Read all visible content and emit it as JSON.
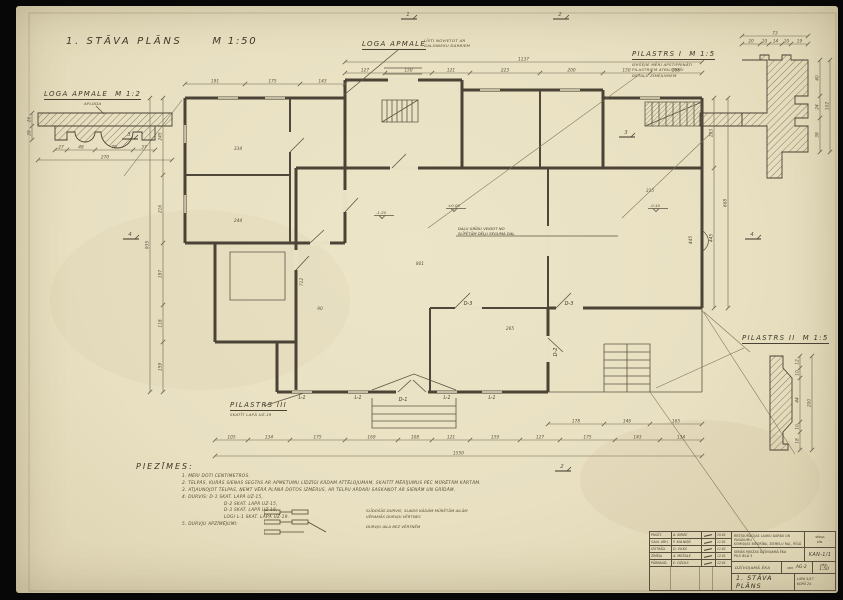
{
  "sheet": {
    "title": "1. STĀVA PLĀNS",
    "scale": "M 1:50"
  },
  "plan": {
    "overall_top": "1137",
    "top_dims": [
      "127",
      "150",
      "121",
      "223",
      "200",
      "150",
      "166"
    ],
    "top_left_dims": [
      "191",
      "175",
      "143"
    ],
    "left_dims": [
      "245",
      "216",
      "197",
      "118",
      "159"
    ],
    "overall_left": "935",
    "right_dims": [
      "223",
      "445"
    ],
    "overall_right": "668",
    "bottom_dims": [
      "105",
      "134",
      "175",
      "169",
      "108",
      "121",
      "159",
      "127",
      "175",
      "143",
      "134"
    ],
    "overall_bottom": "1550",
    "terrace_dims": [
      "178",
      "146",
      "165"
    ],
    "inner_dims": [
      "334",
      "244",
      "801",
      "712",
      "445",
      "315",
      "90",
      "265"
    ],
    "level_marks": [
      "±0.00",
      "-0.45",
      "-1.20"
    ],
    "door_labels": {
      "d1": "D-1",
      "d2": "D-2",
      "d3a": "D-3",
      "d3b": "D-3"
    },
    "window_labels": [
      "L-1",
      "L-1",
      "L-1",
      "L-1"
    ],
    "room_note1": "DAĻU GRĪDU VEIDOT NO",
    "room_note2": "SLĪPĒTĀM DĒĻU SEGUMA DAĻ.",
    "section_markers": [
      "1",
      "2",
      "3",
      "3",
      "4",
      "4",
      "2"
    ]
  },
  "details": {
    "loga_apmale_left": {
      "title": "LOGA APMALE",
      "scale": "M 1:2",
      "subnote": "APLODA",
      "dims": [
        "27",
        "48",
        "70",
        "37"
      ],
      "overall": "270",
      "side_dims": [
        "26",
        "28"
      ]
    },
    "loga_apmale_top": {
      "title": "LOGA APMALE",
      "note1": "LĪSTI NOVIETOT AR",
      "note2": "GALDNIEKU DARBIEM"
    },
    "pilastrs_1": {
      "title": "PILASTRS I",
      "scale": "M 1:5",
      "note1": "IEKŠĒJIE MĒRI APSTIPRINĀTI",
      "note2": "PILASTRIEM ATBILSTOŠI",
      "note3": "DETAĻU ZĪMĒJUMIEM",
      "dims_top": [
        "20",
        "10",
        "14",
        "10",
        "19"
      ],
      "overall_top": "73",
      "dims_right": [
        "40",
        "24",
        "38"
      ],
      "overall_right": "102"
    },
    "pilastrs_2": {
      "title": "PILASTRS II",
      "scale": "M 1:5",
      "dims": [
        "12",
        "10",
        "44",
        "10",
        "18"
      ],
      "overall": "200"
    },
    "pilastrs_3": {
      "title": "PILASTRS III",
      "note": "SKATĪT LAPĀ UZ-19"
    }
  },
  "notes": {
    "heading": "PIEZĪMES:",
    "item1": "1. MĒRI DOTI CENTIMETROS.",
    "item2": "2. TELPĀS, KURĀS SIENAS SEGTAS AR APMETUMU LĪDZĪGI KĀDAM ATTĒLOJUMAM, SKAITĪT MĒRĪJUMUS PĒC MŪRĒTĀM KĀRTĀM.",
    "item3": "3. ATJAUNOJOT TELPAS, ŅEMT VĒRĀ PLĀNĀ DOTOS IZMĒRUS, AR TELPU APDARI SASKAŅOT AR SIENĀM UN GRĪDĀM.",
    "item4": "4. DURVIS: D-1 SKAT. LAPĀ UZ-15,",
    "item4a": "D-2 SKAT. LAPĀ UZ-15,",
    "item4b": "D-3 SKAT. LAPĀ UZ-16,",
    "item4c": "LOGI L-1 SKAT. LAPĀ UZ-19.",
    "item5": "5. DURVJU APZĪMĒJUMI:",
    "legend1": "SLĪDOŠĀS DURVIS, SLAIDS KĀDĀM MŪRĒTĀM AILĀM",
    "legend2": "VĒRAMĀS DURVJU VĒRTNES",
    "legend3": "DURVJU AILA BEZ VĒRTNĒM"
  },
  "titleblock": {
    "rows": [
      {
        "role": "PASŪT.",
        "name": "A. BIRZE",
        "date": "10.81"
      },
      {
        "role": "GALV. ARH.",
        "name": "P. KALNIŅŠ",
        "date": "11.81"
      },
      {
        "role": "IZSTRĀD.",
        "name": "D. VILKS",
        "date": "11.81"
      },
      {
        "role": "ZĪMĒJA",
        "name": "A. MEŽALE",
        "date": "12.81"
      },
      {
        "role": "PĀRBAUD.",
        "name": "E. OZOLS",
        "date": "12.81"
      }
    ],
    "org_line1": "RESTAURĀCIJAS LAUKU DARBU UN PASĀKUMU",
    "org_line2": "KOMISIJAS BIEDRĪBA, ZIEMEĻU RAJ., RĪGĀ",
    "series_label": "SĒRIJA",
    "series_sub": "ZĪM.",
    "object_line1": "SENĀS MUIŽAS DZĪVOJAMĀ ĒKA",
    "object_line2": "PILS IELĀ 3",
    "object_code": "KAN-1/1",
    "building_label": "DZĪVOJAMĀ ĒKA",
    "stage_label": "IZM.",
    "stage_value": "AG-2",
    "scale_label": "MĒR.",
    "scale_value": "1:50",
    "drawing_title": "1. STĀVA PLĀNS",
    "sheet_label": "LAPA 5/17",
    "sheet_total": "KOPĀ 24"
  }
}
